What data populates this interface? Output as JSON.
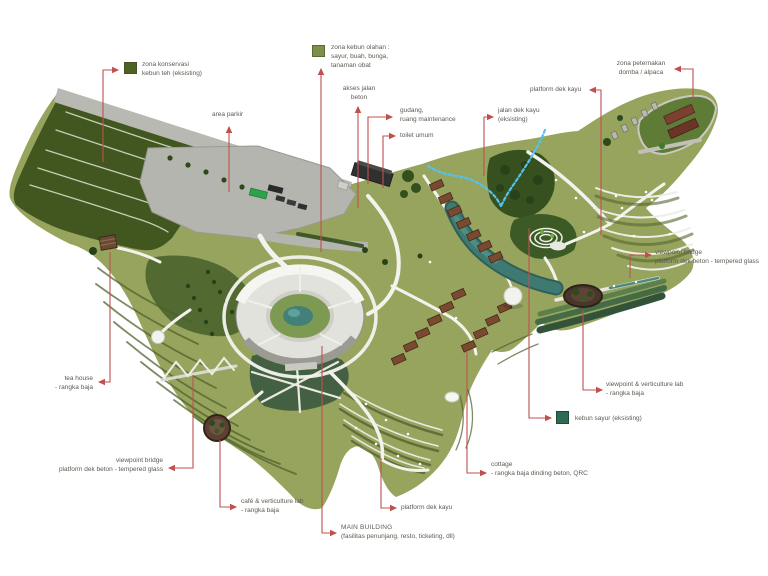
{
  "page": {
    "background": "#ffffff",
    "type": "site-plan-diagram"
  },
  "colors": {
    "leader_red": "#c0504d",
    "label_text": "#5f5a52",
    "tea_zone_swatch": "#4e6323",
    "crop_zone_swatch": "#7e9048",
    "vegetable_swatch": "#2e6b52",
    "terrain_green": "#96a45e",
    "dark_tea_green": "#41571f",
    "river_teal": "#3f7a72",
    "stream_blue": "#54c2ee",
    "path_white": "#f3f3ee",
    "road_grey": "#b5b5af",
    "cottage_roof": "#7a4a30"
  },
  "labels": {
    "zona_konservasi": {
      "line1": "zona konservasi",
      "line2": "kebun teh (eksisting)"
    },
    "zona_kebun_olahan": {
      "line1": "zona kebun olahan :",
      "line2": "sayur, buah, bunga,",
      "line3": "tanaman obat"
    },
    "area_parkir": {
      "line1": "area parkir"
    },
    "akses_jalan": {
      "line1": "akses jalan",
      "line2": "beton"
    },
    "gudang": {
      "line1": "gudang,",
      "line2": "ruang maintenance"
    },
    "toilet": {
      "line1": "toilet umum"
    },
    "platform_dek_kayu_atas": {
      "line1": "platform dek kayu"
    },
    "jalan_dek_kayu": {
      "line1": "jalan dek kayu",
      "line2": "(eksisting)"
    },
    "zona_peternakan": {
      "line1": "zona peternakan",
      "line2": "domba / alpaca"
    },
    "viewpoint_bridge_kanan": {
      "line1": "viewpoint bridge",
      "line2": "platform dek beton - tempered glass"
    },
    "viewpoint_lab_kanan": {
      "line1": "viewpoint & verticulture lab",
      "line2": "- rangka baja"
    },
    "kebun_sayur": {
      "line1": "kebun sayur (eksisting)"
    },
    "cottage": {
      "line1": "cottage",
      "line2": "- rangka baja dinding beton, QRC"
    },
    "platform_dek_kayu_bawah": {
      "line1": "platform dek kayu"
    },
    "main_building": {
      "line1": "MAIN BUILDING",
      "line2": "(fasilitas penunjang, resto, ticketing, dll)"
    },
    "cafe_lab": {
      "line1": "café & verticulture lab",
      "line2": "- rangka baja"
    },
    "viewpoint_bridge_kiri": {
      "line1": "viewpoint bridge",
      "line2": "platform dek beton - tempered glass"
    },
    "tea_house": {
      "line1": "tea house",
      "line2": "- rangka baja"
    }
  }
}
